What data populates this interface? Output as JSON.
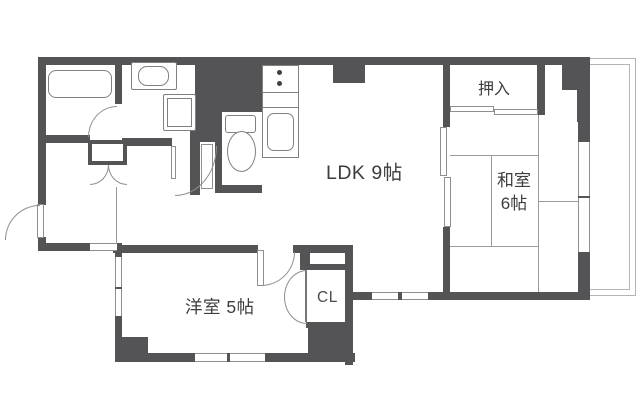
{
  "floorplan": {
    "rooms": [
      {
        "id": "ldk",
        "name": "LDK",
        "size": "9帖",
        "label": "LDK 9帖"
      },
      {
        "id": "washitsu",
        "name": "和室",
        "size_label": "6帖",
        "label": "和室 6帖"
      },
      {
        "id": "yoshitsu",
        "name": "洋室",
        "size": "5帖",
        "label": "洋室 5帖"
      },
      {
        "id": "oshiire",
        "label": "押入"
      },
      {
        "id": "closet",
        "label": "CL"
      }
    ],
    "fixtures": [
      "bathtub",
      "washbasin",
      "washing-machine-pan",
      "toilet",
      "kitchen-stove-burners",
      "kitchen-sink",
      "shoe-cabinet",
      "entry-door",
      "balcony",
      "tatami-mats",
      "sliding-doors"
    ],
    "colors": {
      "wall": "#545456",
      "fixture_line": "#808080",
      "thin_line": "#9b9b9b",
      "balcony_line": "#b4b4b4",
      "label_text": "#3d3d3d",
      "background": "#ffffff"
    }
  }
}
